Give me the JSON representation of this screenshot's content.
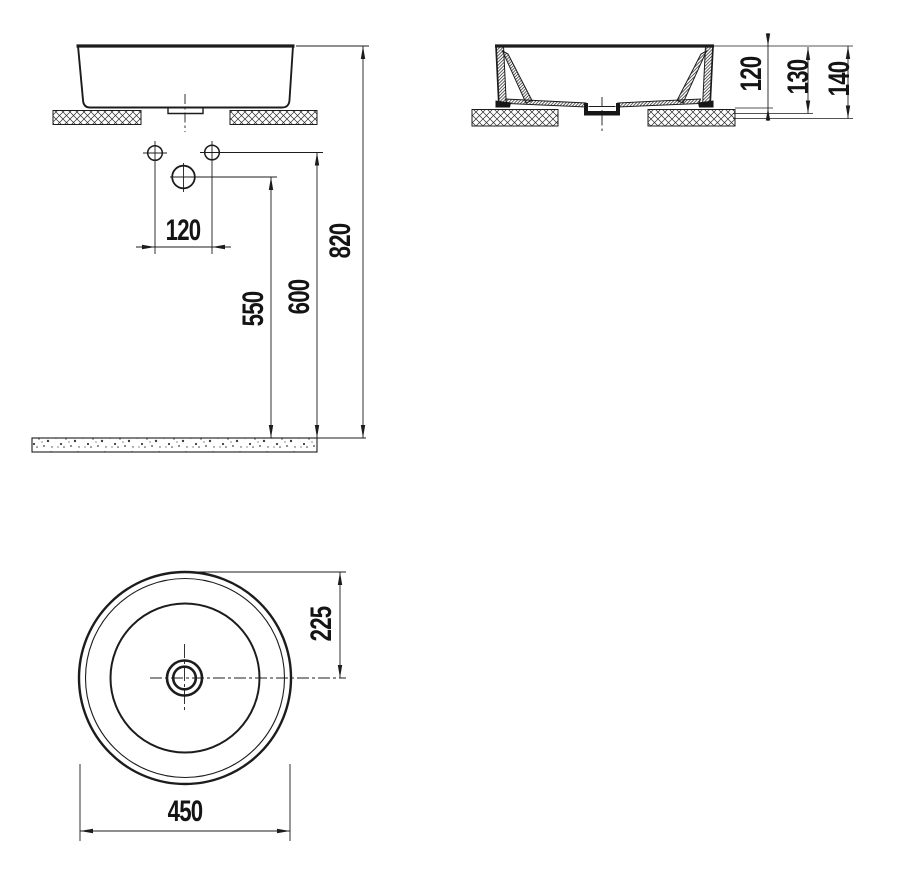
{
  "drawing": {
    "type": "washbasin technical drawing",
    "units": "mm",
    "line_color": "#1c1c1c",
    "background_color": "#ffffff"
  },
  "front_view": {
    "name": "front elevation with installation heights",
    "dim_hole_spacing": "120",
    "dim_height_drain": "550",
    "dim_height_holes": "600",
    "dim_height_rim": "820"
  },
  "section_view": {
    "name": "side cross-section",
    "dim_rim_above_counter": "120",
    "dim_depth_mid": "130",
    "dim_depth_total": "140"
  },
  "top_view": {
    "name": "plan view",
    "dim_radius": "225",
    "dim_diameter": "450"
  }
}
